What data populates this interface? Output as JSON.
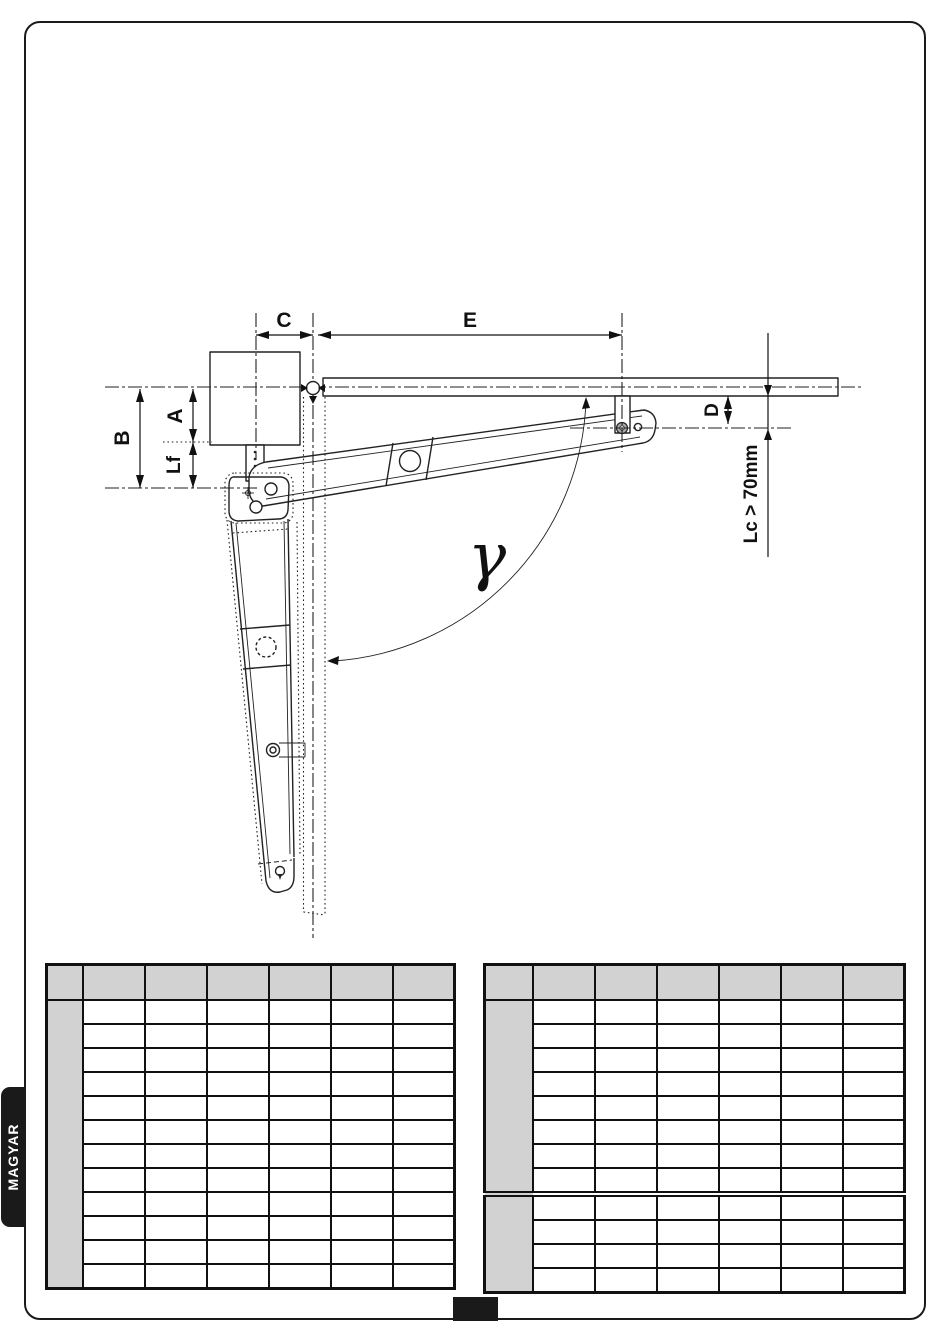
{
  "page": {
    "language_tab": "MAGYAR",
    "frame_color": "#1a1a1a",
    "background": "#ffffff"
  },
  "diagram": {
    "dim_c": "C",
    "dim_e": "E",
    "dim_b": "B",
    "dim_a": "A",
    "dim_lf": "Lf",
    "dim_d": "D",
    "dim_lc": "Lc > 70mm",
    "angle_gamma": "γ"
  },
  "colors": {
    "table_header_fill": "#d2d2d2",
    "table_group_fill": "#d2d2d2",
    "line": "#222222",
    "tab_fill": "#1a1a1a",
    "tab_text": "#ffffff"
  },
  "tables": {
    "left": {
      "columns": 7,
      "first_col_width": 36,
      "col_width": 62,
      "header_rows": 1,
      "body_rows": 12,
      "row_groups": [
        12
      ],
      "cell_text": ""
    },
    "right": {
      "columns": 7,
      "first_col_width": 48,
      "col_width": 62,
      "header_rows": 1,
      "body_rows": 12,
      "row_groups": [
        8,
        4
      ],
      "cell_text": ""
    }
  },
  "footer": {
    "page_block_text": ""
  }
}
